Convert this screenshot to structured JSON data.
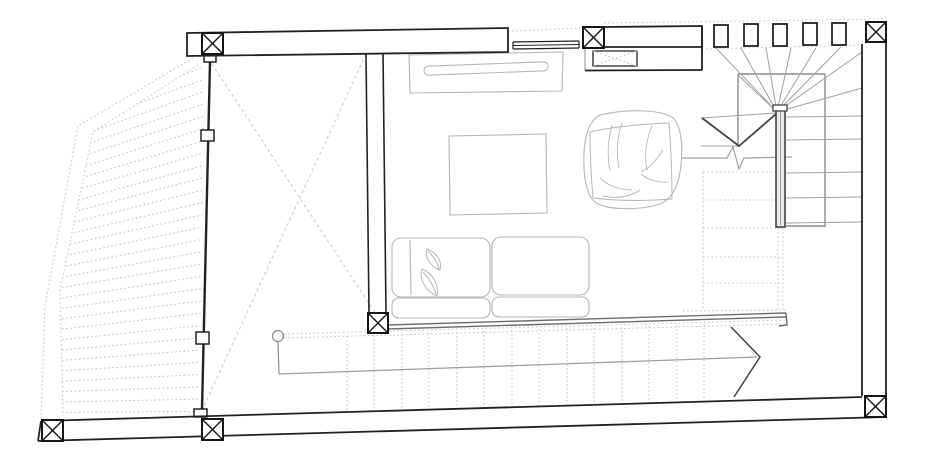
{
  "meta": {
    "kind": "architectural-floor-plan",
    "description": "living level floor plan with deck, glass wall, winder stair and lounge furniture",
    "canvas": {
      "w": 937,
      "h": 471,
      "bg": "#ffffff"
    }
  },
  "palette": {
    "wall": "#222222",
    "col": "#151515",
    "furn": "#b6b6b6",
    "stair": "#a0a0a0",
    "mid": "#8c8c8c",
    "dark": "#424242",
    "rail": "#6e6e6e",
    "guide": "#c7c7c7",
    "hatch": "#c4c4c4",
    "railfill": "#ececec",
    "white": "#ffffff"
  },
  "clips": {
    "deck": "198,65 93,132 60,290 63,416 199,414 205,70"
  },
  "elements": [
    {
      "g": "deck-hatch",
      "t": "gen",
      "x1": 62,
      "y1": 90,
      "s1": 10.4,
      "x2": 204,
      "y2": 30,
      "s2": 12.3,
      "n": 32,
      "stroke": "hatch",
      "dash": "1.6 2.6",
      "w": 1.1,
      "clip": "deck"
    },
    {
      "g": "deck-hatch",
      "t": "polyline",
      "points": "193,58 78,126 45,306 41,419",
      "stroke": "guide",
      "dash": "1.6 2.6",
      "w": 1.1
    },
    {
      "g": "deck-hatch",
      "t": "polyline",
      "points": "198,65 93,132 60,290 63,416",
      "stroke": "guide",
      "dash": "1.6 2.6",
      "w": 1.1
    },
    {
      "g": "projection-guides",
      "t": "line",
      "x1": 212,
      "y1": 64,
      "x2": 385,
      "y2": 328,
      "stroke": "guide",
      "dash": "3 3",
      "w": 1
    },
    {
      "g": "projection-guides",
      "t": "line",
      "x1": 366,
      "y1": 54,
      "x2": 204,
      "y2": 406,
      "stroke": "guide",
      "dash": "3 3",
      "w": 1
    },
    {
      "g": "projection-guides",
      "t": "line",
      "x1": 512,
      "y1": 31,
      "x2": 582,
      "y2": 28,
      "stroke": "guide",
      "dash": "1.6 2.6",
      "w": 1
    },
    {
      "g": "projection-guides",
      "t": "line",
      "x1": 604,
      "y1": 23,
      "x2": 886,
      "y2": 19,
      "stroke": "guide",
      "dash": "1.6 2.6",
      "w": 1
    },
    {
      "g": "projection-guides",
      "t": "line",
      "x1": 702,
      "y1": 49,
      "x2": 862,
      "y2": 45,
      "stroke": "guide",
      "dash": "1.6 2.6",
      "w": 1
    },
    {
      "g": "bottom-stair",
      "t": "line",
      "x1": 284,
      "y1": 334,
      "x2": 786,
      "y2": 320,
      "stroke": "guide",
      "dash": "1.6 2.6",
      "w": 1.1
    },
    {
      "g": "bottom-stair",
      "t": "line",
      "x1": 284,
      "y1": 338,
      "x2": 786,
      "y2": 324,
      "stroke": "guide",
      "dash": "1.6 2.6",
      "w": 1.1
    },
    {
      "g": "bottom-stair",
      "t": "vlines",
      "xs": [
        347,
        374,
        402,
        429,
        457,
        484,
        512,
        539,
        567,
        594,
        622,
        649,
        677,
        704
      ],
      "ya": [
        336,
        335,
        334,
        333,
        332,
        331,
        330,
        329,
        328,
        328,
        327,
        326,
        325,
        324
      ],
      "yb": [
        412,
        411,
        410,
        410,
        409,
        408,
        407,
        406,
        406,
        405,
        404,
        403,
        403,
        402
      ],
      "stroke": "guide",
      "dash": "1.6 2.4",
      "w": 1.1
    },
    {
      "g": "bottom-stair",
      "t": "circle",
      "cx": 278,
      "cy": 336,
      "r": 5.5,
      "stroke": "mid",
      "w": 1.2
    },
    {
      "g": "bottom-stair",
      "t": "line",
      "x1": 278,
      "y1": 342,
      "x2": 279,
      "y2": 374,
      "stroke": "mid",
      "w": 1.2
    },
    {
      "g": "bottom-stair",
      "t": "line",
      "x1": 279,
      "y1": 374,
      "x2": 757,
      "y2": 357,
      "stroke": "stair",
      "w": 1.3
    },
    {
      "g": "bottom-stair",
      "t": "polyline",
      "points": "731,327 760,357 734,397",
      "stroke": "dark",
      "w": 1.5
    },
    {
      "g": "hidden-stair-flight",
      "t": "line",
      "x1": 703,
      "y1": 172,
      "x2": 703,
      "y2": 310,
      "stroke": "guide",
      "dash": "1.6 2.6",
      "w": 1.1
    },
    {
      "g": "hidden-stair-flight",
      "t": "line",
      "x1": 778,
      "y1": 228,
      "x2": 778,
      "y2": 310,
      "stroke": "guide",
      "dash": "1.6 2.6",
      "w": 1.1
    },
    {
      "g": "hidden-stair-flight",
      "t": "line",
      "x1": 783,
      "y1": 228,
      "x2": 783,
      "y2": 310,
      "stroke": "guide",
      "dash": "1.6 2.6",
      "w": 1.1
    },
    {
      "g": "hidden-stair-flight",
      "t": "line",
      "x1": 703,
      "y1": 172,
      "x2": 777,
      "y2": 172,
      "stroke": "guide",
      "dash": "1.6 2.6",
      "w": 1.1
    },
    {
      "g": "hidden-stair-flight",
      "t": "line",
      "x1": 703,
      "y1": 200,
      "x2": 777,
      "y2": 200,
      "stroke": "guide",
      "dash": "1.6 2.6",
      "w": 1.1
    },
    {
      "g": "hidden-stair-flight",
      "t": "line",
      "x1": 703,
      "y1": 228,
      "x2": 783,
      "y2": 228,
      "stroke": "guide",
      "dash": "1.6 2.6",
      "w": 1.1
    },
    {
      "g": "hidden-stair-flight",
      "t": "line",
      "x1": 703,
      "y1": 257,
      "x2": 783,
      "y2": 257,
      "stroke": "guide",
      "dash": "1.6 2.6",
      "w": 1.1
    },
    {
      "g": "hidden-stair-flight",
      "t": "line",
      "x1": 703,
      "y1": 283,
      "x2": 783,
      "y2": 283,
      "stroke": "guide",
      "dash": "1.6 2.6",
      "w": 1.1
    },
    {
      "g": "hidden-stair-flight",
      "t": "line",
      "x1": 683,
      "y1": 311,
      "x2": 786,
      "y2": 310,
      "stroke": "guide",
      "dash": "1.6 2.6",
      "w": 1.1
    },
    {
      "g": "winder-stair",
      "t": "line",
      "x1": 738,
      "y1": 74,
      "x2": 825,
      "y2": 74,
      "stroke": "mid",
      "w": 1.4
    },
    {
      "g": "winder-stair",
      "t": "line",
      "x1": 825,
      "y1": 74,
      "x2": 825,
      "y2": 227,
      "stroke": "mid",
      "w": 1.4
    },
    {
      "g": "winder-stair",
      "t": "line",
      "x1": 738,
      "y1": 74,
      "x2": 738,
      "y2": 147,
      "stroke": "mid",
      "w": 1.4
    },
    {
      "g": "winder-stair",
      "t": "line",
      "x1": 786,
      "y1": 226,
      "x2": 825,
      "y2": 226,
      "stroke": "mid",
      "w": 1.4
    },
    {
      "g": "winder-stair",
      "t": "line",
      "x1": 777,
      "y1": 112,
      "x2": 738,
      "y2": 75,
      "stroke": "stair",
      "w": 1
    },
    {
      "g": "winder-stair",
      "t": "line",
      "x1": 777,
      "y1": 112,
      "x2": 716,
      "y2": 48,
      "stroke": "stair",
      "w": 1
    },
    {
      "g": "winder-stair",
      "t": "line",
      "x1": 777,
      "y1": 112,
      "x2": 741,
      "y2": 48,
      "stroke": "stair",
      "w": 1
    },
    {
      "g": "winder-stair",
      "t": "line",
      "x1": 777,
      "y1": 112,
      "x2": 766,
      "y2": 48,
      "stroke": "stair",
      "w": 1
    },
    {
      "g": "winder-stair",
      "t": "line",
      "x1": 777,
      "y1": 112,
      "x2": 791,
      "y2": 48,
      "stroke": "stair",
      "w": 1
    },
    {
      "g": "winder-stair",
      "t": "line",
      "x1": 777,
      "y1": 112,
      "x2": 816,
      "y2": 48,
      "stroke": "stair",
      "w": 1
    },
    {
      "g": "winder-stair",
      "t": "line",
      "x1": 777,
      "y1": 112,
      "x2": 841,
      "y2": 47,
      "stroke": "stair",
      "w": 1
    },
    {
      "g": "winder-stair",
      "t": "line",
      "x1": 777,
      "y1": 112,
      "x2": 862,
      "y2": 52,
      "stroke": "stair",
      "w": 1
    },
    {
      "g": "winder-stair",
      "t": "line",
      "x1": 777,
      "y1": 112,
      "x2": 862,
      "y2": 88,
      "stroke": "stair",
      "w": 1
    },
    {
      "g": "winder-stair",
      "t": "line",
      "x1": 701,
      "y1": 118,
      "x2": 776,
      "y2": 113,
      "stroke": "stair",
      "w": 1
    },
    {
      "g": "winder-stair",
      "t": "line",
      "x1": 701,
      "y1": 146,
      "x2": 739,
      "y2": 146,
      "stroke": "stair",
      "w": 1
    },
    {
      "g": "winder-stair",
      "t": "polyline",
      "points": "702,118 739,146 776,114",
      "stroke": "dark",
      "w": 1.8
    },
    {
      "g": "winder-stair",
      "t": "path",
      "d": "M683,158 L727,158 L733,147 L739,169 L744,158 L792,157",
      "stroke": "stair",
      "w": 1.2
    },
    {
      "g": "winder-stair",
      "t": "line",
      "x1": 786,
      "y1": 117,
      "x2": 862,
      "y2": 116,
      "stroke": "stair",
      "w": 1
    },
    {
      "g": "winder-stair",
      "t": "line",
      "x1": 786,
      "y1": 140,
      "x2": 862,
      "y2": 139,
      "stroke": "stair",
      "w": 1
    },
    {
      "g": "winder-stair",
      "t": "line",
      "x1": 786,
      "y1": 173,
      "x2": 862,
      "y2": 172,
      "stroke": "stair",
      "w": 1
    },
    {
      "g": "winder-stair",
      "t": "line",
      "x1": 786,
      "y1": 198,
      "x2": 862,
      "y2": 197,
      "stroke": "stair",
      "w": 1
    },
    {
      "g": "winder-stair",
      "t": "line",
      "x1": 786,
      "y1": 223,
      "x2": 862,
      "y2": 222,
      "stroke": "stair",
      "w": 1
    },
    {
      "g": "winder-stair",
      "t": "rect",
      "x": 776,
      "y": 108,
      "wd": 9,
      "h": 119,
      "stroke": "dark",
      "w": 1.6,
      "fill": "railfill"
    },
    {
      "g": "winder-stair",
      "t": "line",
      "x1": 780.5,
      "y1": 110,
      "x2": 780.5,
      "y2": 225,
      "stroke": "stair",
      "w": 1
    },
    {
      "g": "winder-stair",
      "t": "rect",
      "x": 773,
      "y": 105,
      "wd": 14,
      "h": 6,
      "stroke": "dark",
      "w": 1.3,
      "fill": "white"
    },
    {
      "g": "tv-console",
      "t": "polygon",
      "points": "409,55 563,52 562,91 410,93",
      "stroke": "furn",
      "w": 1.1
    },
    {
      "g": "tv-console",
      "t": "rect",
      "x": 424,
      "y": 64,
      "wd": 124,
      "h": 9,
      "rx": 4,
      "stroke": "furn",
      "w": 1.1,
      "rot": "-2.2 486 68"
    },
    {
      "g": "coffee-table",
      "t": "polygon",
      "points": "449,136 546,134 547,213 450,215",
      "stroke": "furn",
      "w": 1.1
    },
    {
      "g": "sofa",
      "t": "rect",
      "x": 392,
      "y": 238,
      "wd": 98,
      "h": 59,
      "rx": 9,
      "stroke": "furn",
      "w": 1.1
    },
    {
      "g": "sofa",
      "t": "rect",
      "x": 492,
      "y": 237,
      "wd": 97,
      "h": 58,
      "rx": 9,
      "stroke": "furn",
      "w": 1.1
    },
    {
      "g": "sofa",
      "t": "line",
      "x1": 410,
      "y1": 240,
      "x2": 411,
      "y2": 295,
      "stroke": "furn",
      "w": 1.1
    },
    {
      "g": "sofa",
      "t": "rect",
      "x": 392,
      "y": 298,
      "wd": 98,
      "h": 20,
      "rx": 7,
      "stroke": "furn",
      "w": 1.1
    },
    {
      "g": "sofa",
      "t": "rect",
      "x": 492,
      "y": 297,
      "wd": 97,
      "h": 20,
      "rx": 7,
      "stroke": "furn",
      "w": 1.1
    },
    {
      "g": "sofa",
      "t": "path",
      "d": "M427,249 C438,253 442,262 440,270 C429,266 425,257 427,249 Z",
      "stroke": "furn",
      "w": 1
    },
    {
      "g": "sofa",
      "t": "path",
      "d": "M428,251 C434,257 438,263 439,269",
      "stroke": "furn",
      "w": 1
    },
    {
      "g": "sofa",
      "t": "path",
      "d": "M422,269 C433,273 439,285 437,296 C425,291 419,279 422,269 Z",
      "stroke": "furn",
      "w": 1
    },
    {
      "g": "sofa",
      "t": "path",
      "d": "M423,272 C430,279 434,287 436,294",
      "stroke": "furn",
      "w": 1
    },
    {
      "g": "bean-bag",
      "t": "path",
      "d": "M600,115 C630,108 662,110 673,118 C681,125 683,145 681,165 C679,185 673,198 660,204 C638,211 606,210 595,202 C586,195 583,175 584,153 C585,133 590,120 600,115 Z",
      "stroke": "furn",
      "w": 1.1
    },
    {
      "g": "bean-bag",
      "t": "path",
      "d": "M590,132 C615,126 645,124 669,123 C671,148 672,174 672,199 C646,201 618,201 593,198 C591,176 590,154 590,132 Z",
      "stroke": "furn",
      "w": 1
    },
    {
      "g": "bean-bag",
      "t": "path",
      "d": "M612,125 C608,140 607,156 610,170",
      "stroke": "furn",
      "w": 0.9
    },
    {
      "g": "bean-bag",
      "t": "path",
      "d": "M622,123 C617,138 616,154 619,168",
      "stroke": "furn",
      "w": 0.9
    },
    {
      "g": "bean-bag",
      "t": "path",
      "d": "M652,126 C646,140 644,156 647,170",
      "stroke": "furn",
      "w": 0.9
    },
    {
      "g": "bean-bag",
      "t": "path",
      "d": "M663,150 C656,160 650,168 641,172",
      "stroke": "furn",
      "w": 0.9
    },
    {
      "g": "bean-bag",
      "t": "path",
      "d": "M641,174 C648,180 658,183 668,182",
      "stroke": "furn",
      "w": 0.9
    },
    {
      "g": "bean-bag",
      "t": "path",
      "d": "M600,178 C608,186 620,190 632,190",
      "stroke": "furn",
      "w": 0.9
    },
    {
      "g": "bean-bag",
      "t": "path",
      "d": "M640,190 C630,197 616,199 603,196",
      "stroke": "furn",
      "w": 0.9
    },
    {
      "g": "bean-bag",
      "t": "line",
      "x1": 681,
      "y1": 158,
      "x2": 700,
      "y2": 158,
      "stroke": "stair",
      "w": 1
    },
    {
      "g": "sofa-rail",
      "t": "line",
      "x1": 388,
      "y1": 325,
      "x2": 786,
      "y2": 313,
      "stroke": "rail",
      "w": 1.4
    },
    {
      "g": "sofa-rail",
      "t": "line",
      "x1": 388,
      "y1": 329,
      "x2": 786,
      "y2": 317,
      "stroke": "rail",
      "w": 1.4
    },
    {
      "g": "sofa-rail",
      "t": "path",
      "d": "M786,313 L787,325 L779,326",
      "stroke": "rail",
      "w": 1.4
    },
    {
      "g": "sofa-rail",
      "t": "line",
      "x1": 388,
      "y1": 325,
      "x2": 388,
      "y2": 329,
      "stroke": "rail",
      "w": 1.4
    },
    {
      "g": "glass-wall",
      "t": "line",
      "x1": 210,
      "y1": 62,
      "x2": 202,
      "y2": 410,
      "stroke": "wall",
      "w": 2.4
    },
    {
      "g": "glass-wall",
      "t": "rect",
      "x": 204,
      "y": 55,
      "wd": 12,
      "h": 7,
      "stroke": "col",
      "w": 1.4,
      "fill": "white"
    },
    {
      "g": "glass-wall",
      "t": "rect",
      "x": 201,
      "y": 130,
      "wd": 13,
      "h": 11,
      "stroke": "col",
      "w": 1.4,
      "fill": "white"
    },
    {
      "g": "glass-wall",
      "t": "rect",
      "x": 196,
      "y": 332,
      "wd": 13,
      "h": 12,
      "stroke": "col",
      "w": 1.4,
      "fill": "white"
    },
    {
      "g": "glass-wall",
      "t": "rect",
      "x": 194,
      "y": 409,
      "wd": 13,
      "h": 8,
      "stroke": "col",
      "w": 1.4,
      "fill": "white"
    },
    {
      "g": "interior-wall",
      "t": "line",
      "x1": 366,
      "y1": 54,
      "x2": 369,
      "y2": 313,
      "stroke": "wall",
      "w": 1.6
    },
    {
      "g": "interior-wall",
      "t": "line",
      "x1": 383,
      "y1": 53,
      "x2": 386,
      "y2": 313,
      "stroke": "wall",
      "w": 1.6
    },
    {
      "g": "walls",
      "t": "polygon",
      "points": "187,33 508,28 508,52 187,56",
      "stroke": "wall",
      "w": 1.8,
      "fill": "white"
    },
    {
      "g": "walls",
      "t": "polygon",
      "points": "604,27 702,26 702,47 604,47",
      "stroke": "wall",
      "w": 1.8,
      "fill": "white"
    },
    {
      "g": "walls",
      "t": "line",
      "x1": 585,
      "y1": 48,
      "x2": 585,
      "y2": 70,
      "stroke": "mid",
      "w": 1
    },
    {
      "g": "walls",
      "t": "line",
      "x1": 585,
      "y1": 70.5,
      "x2": 702,
      "y2": 70,
      "stroke": "wall",
      "w": 1.8
    },
    {
      "g": "walls",
      "t": "line",
      "x1": 702,
      "y1": 26,
      "x2": 702,
      "y2": 70.5,
      "stroke": "wall",
      "w": 1.8
    },
    {
      "g": "walls",
      "t": "polygon",
      "points": "593,51 637,51 637,66 593,66",
      "stroke": "wall",
      "w": 1.3,
      "fill": "white"
    },
    {
      "g": "walls",
      "t": "line",
      "x1": 593,
      "y1": 51,
      "x2": 637,
      "y2": 66,
      "stroke": "guide",
      "dash": "2 2",
      "w": 1
    },
    {
      "g": "walls",
      "t": "line",
      "x1": 637,
      "y1": 51,
      "x2": 593,
      "y2": 66,
      "stroke": "guide",
      "dash": "2 2",
      "w": 1
    },
    {
      "g": "walls",
      "t": "line",
      "x1": 862,
      "y1": 44,
      "x2": 862,
      "y2": 396,
      "stroke": "wall",
      "w": 1.8
    },
    {
      "g": "walls",
      "t": "line",
      "x1": 886,
      "y1": 43,
      "x2": 886,
      "y2": 417,
      "stroke": "wall",
      "w": 1.8
    },
    {
      "g": "walls",
      "t": "line",
      "x1": 41,
      "y1": 421,
      "x2": 862,
      "y2": 397,
      "stroke": "wall",
      "w": 1.8
    },
    {
      "g": "walls",
      "t": "line",
      "x1": 38,
      "y1": 441,
      "x2": 886,
      "y2": 417,
      "stroke": "wall",
      "w": 1.8
    },
    {
      "g": "walls",
      "t": "line",
      "x1": 41,
      "y1": 421,
      "x2": 38,
      "y2": 441,
      "stroke": "wall",
      "w": 1.8
    },
    {
      "g": "windows",
      "t": "line",
      "x1": 513,
      "y1": 42,
      "x2": 579,
      "y2": 41,
      "stroke": "wall",
      "w": 1.2
    },
    {
      "g": "windows",
      "t": "line",
      "x1": 513,
      "y1": 45.5,
      "x2": 579,
      "y2": 44.5,
      "stroke": "wall",
      "w": 1
    },
    {
      "g": "windows",
      "t": "line",
      "x1": 513,
      "y1": 49,
      "x2": 579,
      "y2": 48,
      "stroke": "wall",
      "w": 1.2
    },
    {
      "g": "windows",
      "t": "line",
      "x1": 513,
      "y1": 42,
      "x2": 513,
      "y2": 49,
      "stroke": "wall",
      "w": 1.2
    },
    {
      "g": "windows",
      "t": "line",
      "x1": 579,
      "y1": 41,
      "x2": 579,
      "y2": 48,
      "stroke": "wall",
      "w": 1.2
    },
    {
      "g": "windows",
      "t": "rect",
      "x": 714,
      "y": 25,
      "wd": 14,
      "h": 22,
      "stroke": "wall",
      "w": 1.8,
      "fill": "white"
    },
    {
      "g": "windows",
      "t": "rect",
      "x": 744,
      "y": 24,
      "wd": 14,
      "h": 22,
      "stroke": "wall",
      "w": 1.8,
      "fill": "white"
    },
    {
      "g": "windows",
      "t": "rect",
      "x": 773,
      "y": 24,
      "wd": 14,
      "h": 22,
      "stroke": "wall",
      "w": 1.8,
      "fill": "white"
    },
    {
      "g": "windows",
      "t": "rect",
      "x": 803,
      "y": 23,
      "wd": 14,
      "h": 22,
      "stroke": "wall",
      "w": 1.8,
      "fill": "white"
    },
    {
      "g": "windows",
      "t": "rect",
      "x": 832,
      "y": 23,
      "wd": 14,
      "h": 22,
      "stroke": "wall",
      "w": 1.8,
      "fill": "white"
    },
    {
      "g": "columns",
      "t": "column",
      "x": 202,
      "y": 33,
      "s": 21
    },
    {
      "g": "columns",
      "t": "column",
      "x": 583,
      "y": 27,
      "s": 21
    },
    {
      "g": "columns",
      "t": "column",
      "x": 866,
      "y": 22,
      "s": 20
    },
    {
      "g": "columns",
      "t": "column",
      "x": 368,
      "y": 313,
      "s": 20
    },
    {
      "g": "columns",
      "t": "column",
      "x": 42,
      "y": 420,
      "s": 21
    },
    {
      "g": "columns",
      "t": "column",
      "x": 202,
      "y": 419,
      "s": 21
    },
    {
      "g": "columns",
      "t": "column",
      "x": 865,
      "y": 396,
      "s": 21
    }
  ]
}
